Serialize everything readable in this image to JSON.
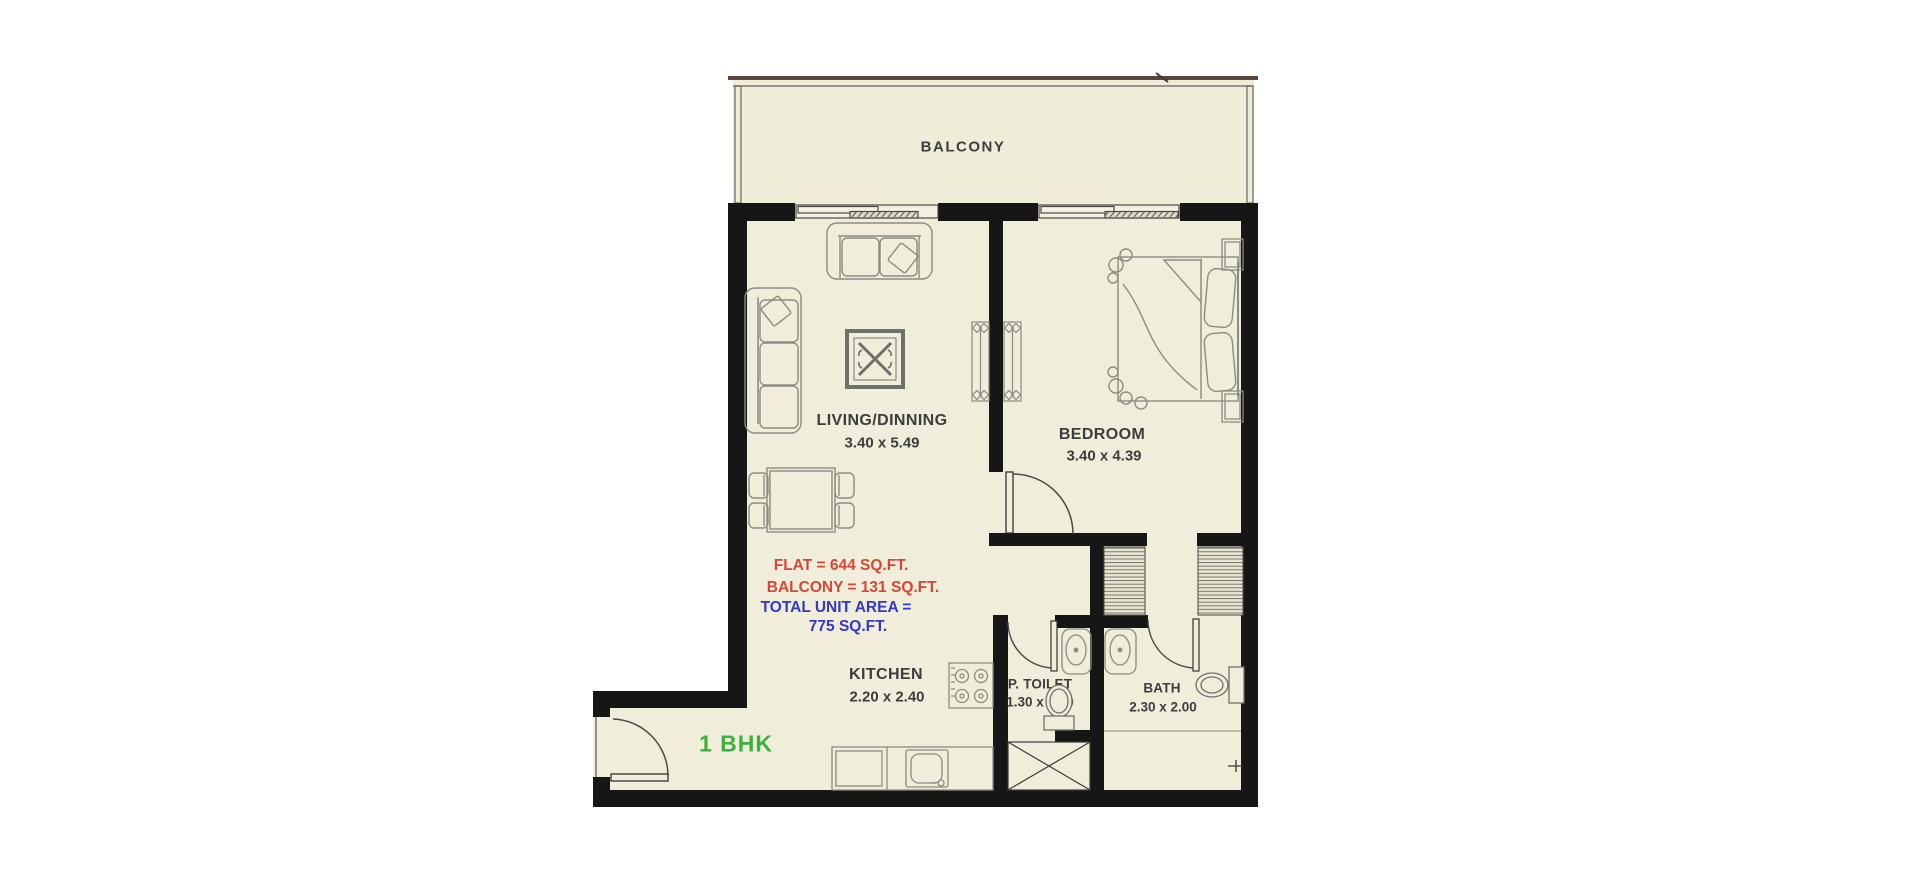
{
  "plan_title": "1 BHK apartment floor plan",
  "rooms": {
    "balcony": {
      "name": "BALCONY"
    },
    "living": {
      "name": "LIVING/DINNING",
      "dims": "3.40 x 5.49"
    },
    "bedroom": {
      "name": "BEDROOM",
      "dims": "3.40 x 4.39"
    },
    "kitchen": {
      "name": "KITCHEN",
      "dims": "2.20 x 2.40"
    },
    "toilet": {
      "name": "P. TOILET",
      "dims": "1.30 x 1.50"
    },
    "bath": {
      "name": "BATH",
      "dims": "2.30 x 2.00"
    }
  },
  "area_summary": {
    "flat_line": "FLAT = 644 SQ.FT.",
    "balcony_line": "BALCONY = 131 SQ.FT.",
    "total_label": "TOTAL UNIT AREA =",
    "total_value": "775 SQ.FT."
  },
  "unit_type": "1 BHK",
  "colors": {
    "flat_area_text": "#d84638",
    "total_area_text": "#3438c8",
    "unit_type_text": "#3cb13c",
    "walls": "#161616",
    "floor": "#f0edda",
    "furniture_line": "#8c8c82"
  }
}
